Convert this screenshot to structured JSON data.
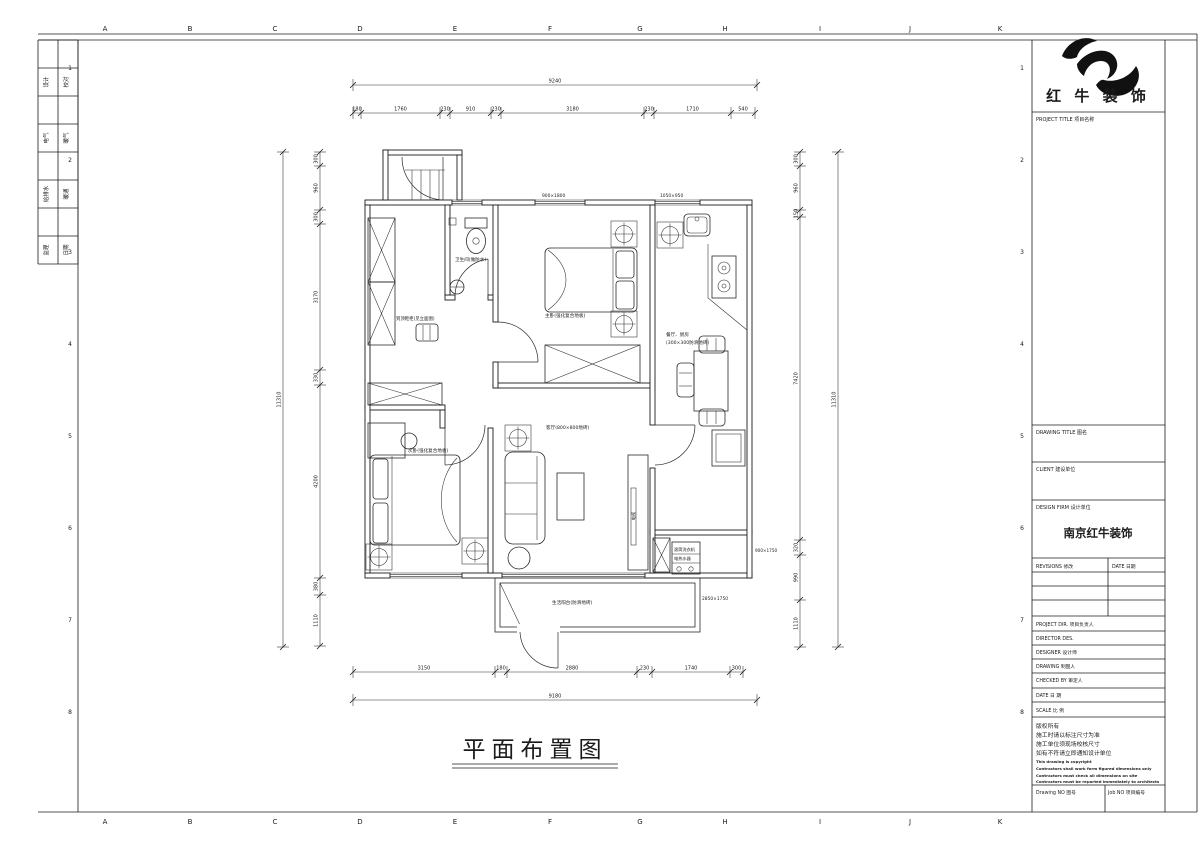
{
  "sheet": {
    "grid": {
      "letters": [
        "A",
        "B",
        "C",
        "D",
        "E",
        "F",
        "G",
        "H",
        "I",
        "J",
        "K"
      ],
      "numbers": [
        "1",
        "2",
        "3",
        "4",
        "5",
        "6",
        "7",
        "8"
      ]
    },
    "signoff": {
      "rows": [
        {
          "left": "设计",
          "right": "校对"
        },
        {
          "left": "电气",
          "right": "暖气"
        },
        {
          "left": "给排水",
          "right": "暖通"
        },
        {
          "left": "监理",
          "right": "日期"
        }
      ]
    },
    "title_block": {
      "logo_text": "红 牛 装 饰",
      "project_title_label": "PROJECT TITLE  项目名称",
      "drawing_title_label": "DRAWING TITLE  图名",
      "client_label": "CLIENT  建设单位",
      "design_firm_label": "DESIGN FIRM  设计单位",
      "design_firm_value": "南京红牛装饰",
      "revisions_label": "REVISIONS  修改",
      "date_col_label": "DATE  日期",
      "rows": [
        "PROJECT DIR.  项目负责人",
        "DIRECTOR DES.",
        "DESIGNER   设计师",
        "DRAWING    制图人",
        "CHECKED BY  审定人",
        "DATE       日  期",
        "SCALE      比  例"
      ],
      "notes_zh": [
        "版权所有",
        "施工时请以标注尺寸为准",
        "施工单位须现场校核尺寸",
        "如有不符请立即通知设计单位"
      ],
      "notes_en": [
        "This drawing is copyright",
        "Contractors shall work form figured dimensions only",
        "Contractors must check all dimensions on site",
        "Contractors must be reported immediately to architects"
      ],
      "drawing_no_label": "Drawing NO  图号",
      "job_no_label": "Job NO  项目编号"
    },
    "drawing_title": "平面布置图"
  },
  "plan": {
    "room_labels": [
      {
        "x": 455,
        "y": 261,
        "t": "卫生间(做防水)",
        "fs": 4.6
      },
      {
        "x": 396,
        "y": 320,
        "t": "到顶鞋柜(见立面图)",
        "fs": 4.4
      },
      {
        "x": 545,
        "y": 317,
        "t": "主卧(强化复合地板)",
        "fs": 4.6
      },
      {
        "x": 408,
        "y": 452,
        "t": "次卧(强化复合地板)",
        "fs": 4.6
      },
      {
        "x": 546,
        "y": 429,
        "t": "客厅(800×800地砖)",
        "fs": 4.6
      },
      {
        "x": 666,
        "y": 336,
        "t": "餐厅、厨房",
        "fs": 4.6
      },
      {
        "x": 666,
        "y": 344,
        "t": "(300×300防滑地砖)",
        "fs": 4.6
      },
      {
        "x": 552,
        "y": 604,
        "t": "生活阳台(防滑地砖)",
        "fs": 4.6
      },
      {
        "x": 674,
        "y": 551,
        "t": "滚筒洗衣机",
        "fs": 4.2
      },
      {
        "x": 674,
        "y": 560,
        "t": "电热水器",
        "fs": 4.2
      },
      {
        "x": 635,
        "y": 516,
        "t": "电视",
        "fs": 4.2,
        "rot": -90,
        "a": "middle"
      },
      {
        "x": 542,
        "y": 197,
        "t": "900×1800",
        "fs": 4.4
      },
      {
        "x": 660,
        "y": 197,
        "t": "1050×950",
        "fs": 4.4
      },
      {
        "x": 702,
        "y": 600,
        "t": "2850×1750",
        "fs": 4.4
      },
      {
        "x": 755,
        "y": 552,
        "t": "900×1750",
        "fs": 4.2
      }
    ],
    "dimensions": [
      {
        "id": "top-overall",
        "o": "h",
        "y": 85,
        "ticks": [
          353,
          757
        ],
        "labels": [
          "9240"
        ]
      },
      {
        "id": "top-segments",
        "o": "h",
        "y": 113,
        "ticks": [
          353,
          361,
          440,
          450,
          491,
          501,
          644,
          654,
          731,
          755
        ],
        "labels": [
          "180",
          "1760",
          "230",
          "910",
          "230",
          "3180",
          "230",
          "1710",
          "540"
        ]
      },
      {
        "id": "bottom-segments",
        "o": "h",
        "y": 672,
        "ticks": [
          353,
          495,
          507,
          637,
          652,
          730,
          743
        ],
        "labels": [
          "3150",
          "180",
          "2880",
          "230",
          "1740",
          "300"
        ]
      },
      {
        "id": "bottom-overall",
        "o": "h",
        "y": 700,
        "ticks": [
          353,
          757
        ],
        "labels": [
          "9180"
        ]
      },
      {
        "id": "left-overall",
        "o": "v",
        "x": 283,
        "ticks": [
          152,
          647
        ],
        "labels": [
          "11310"
        ]
      },
      {
        "id": "left-segments",
        "o": "v",
        "x": 320,
        "ticks": [
          152,
          166,
          210,
          224,
          370,
          385,
          578,
          595,
          646
        ],
        "labels": [
          "300",
          "960",
          "300",
          "3170",
          "330",
          "4200",
          "380",
          "1110"
        ]
      },
      {
        "id": "right-segments",
        "o": "v",
        "x": 800,
        "ticks": [
          152,
          166,
          210,
          217,
          540,
          555,
          600,
          647
        ],
        "labels": [
          "300",
          "960",
          "150",
          "7420",
          "320",
          "990",
          "1110"
        ]
      },
      {
        "id": "right-overall",
        "o": "v",
        "x": 838,
        "ticks": [
          152,
          647
        ],
        "labels": [
          "11310"
        ]
      }
    ]
  }
}
